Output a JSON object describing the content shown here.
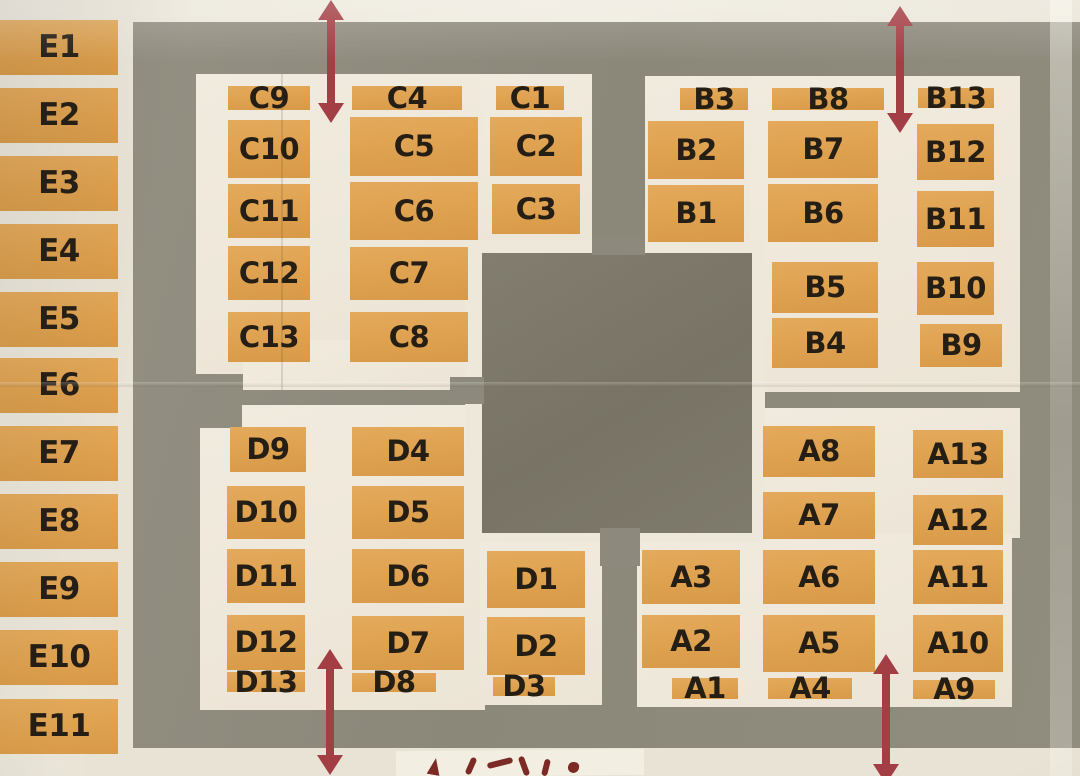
{
  "map": {
    "description": "Photographed paper venue map with numbered booth blocks in five zones and two-way entrance arrows"
  },
  "zones": {
    "E": {
      "blocks": [
        "E1",
        "E2",
        "E3",
        "E4",
        "E5",
        "E6",
        "E7",
        "E8",
        "E9",
        "E10",
        "E11"
      ]
    },
    "C": {
      "blocks": [
        "C9",
        "C10",
        "C11",
        "C12",
        "C13",
        "C4",
        "C5",
        "C6",
        "C7",
        "C8",
        "C1",
        "C2",
        "C3"
      ]
    },
    "B": {
      "blocks": [
        "B3",
        "B2",
        "B1",
        "B8",
        "B7",
        "B6",
        "B5",
        "B4",
        "B13",
        "B12",
        "B11",
        "B10",
        "B9"
      ]
    },
    "D": {
      "blocks": [
        "D9",
        "D10",
        "D11",
        "D12",
        "D13",
        "D4",
        "D5",
        "D6",
        "D7",
        "D8",
        "D1",
        "D2",
        "D3"
      ]
    },
    "A": {
      "blocks": [
        "A8",
        "A7",
        "A13",
        "A12",
        "A3",
        "A6",
        "A11",
        "A2",
        "A5",
        "A10",
        "A1",
        "A4",
        "A9"
      ]
    }
  },
  "arrows": [
    {
      "id": "top-left",
      "direction": "two-way-vertical"
    },
    {
      "id": "top-right",
      "direction": "two-way-vertical"
    },
    {
      "id": "bottom-left",
      "direction": "two-way-vertical"
    },
    {
      "id": "bottom-right",
      "direction": "two-way-vertical"
    }
  ],
  "annotations": {
    "bottom_marks": "partial red handwriting cut off at bottom edge"
  },
  "colors": {
    "paper": "#e8e3d5",
    "island": "#efe9dc",
    "road": "#8d897c",
    "center_block": "#7b7668",
    "booth": "#dfa354",
    "label": "#251e15",
    "arrow": "#a43e45"
  }
}
